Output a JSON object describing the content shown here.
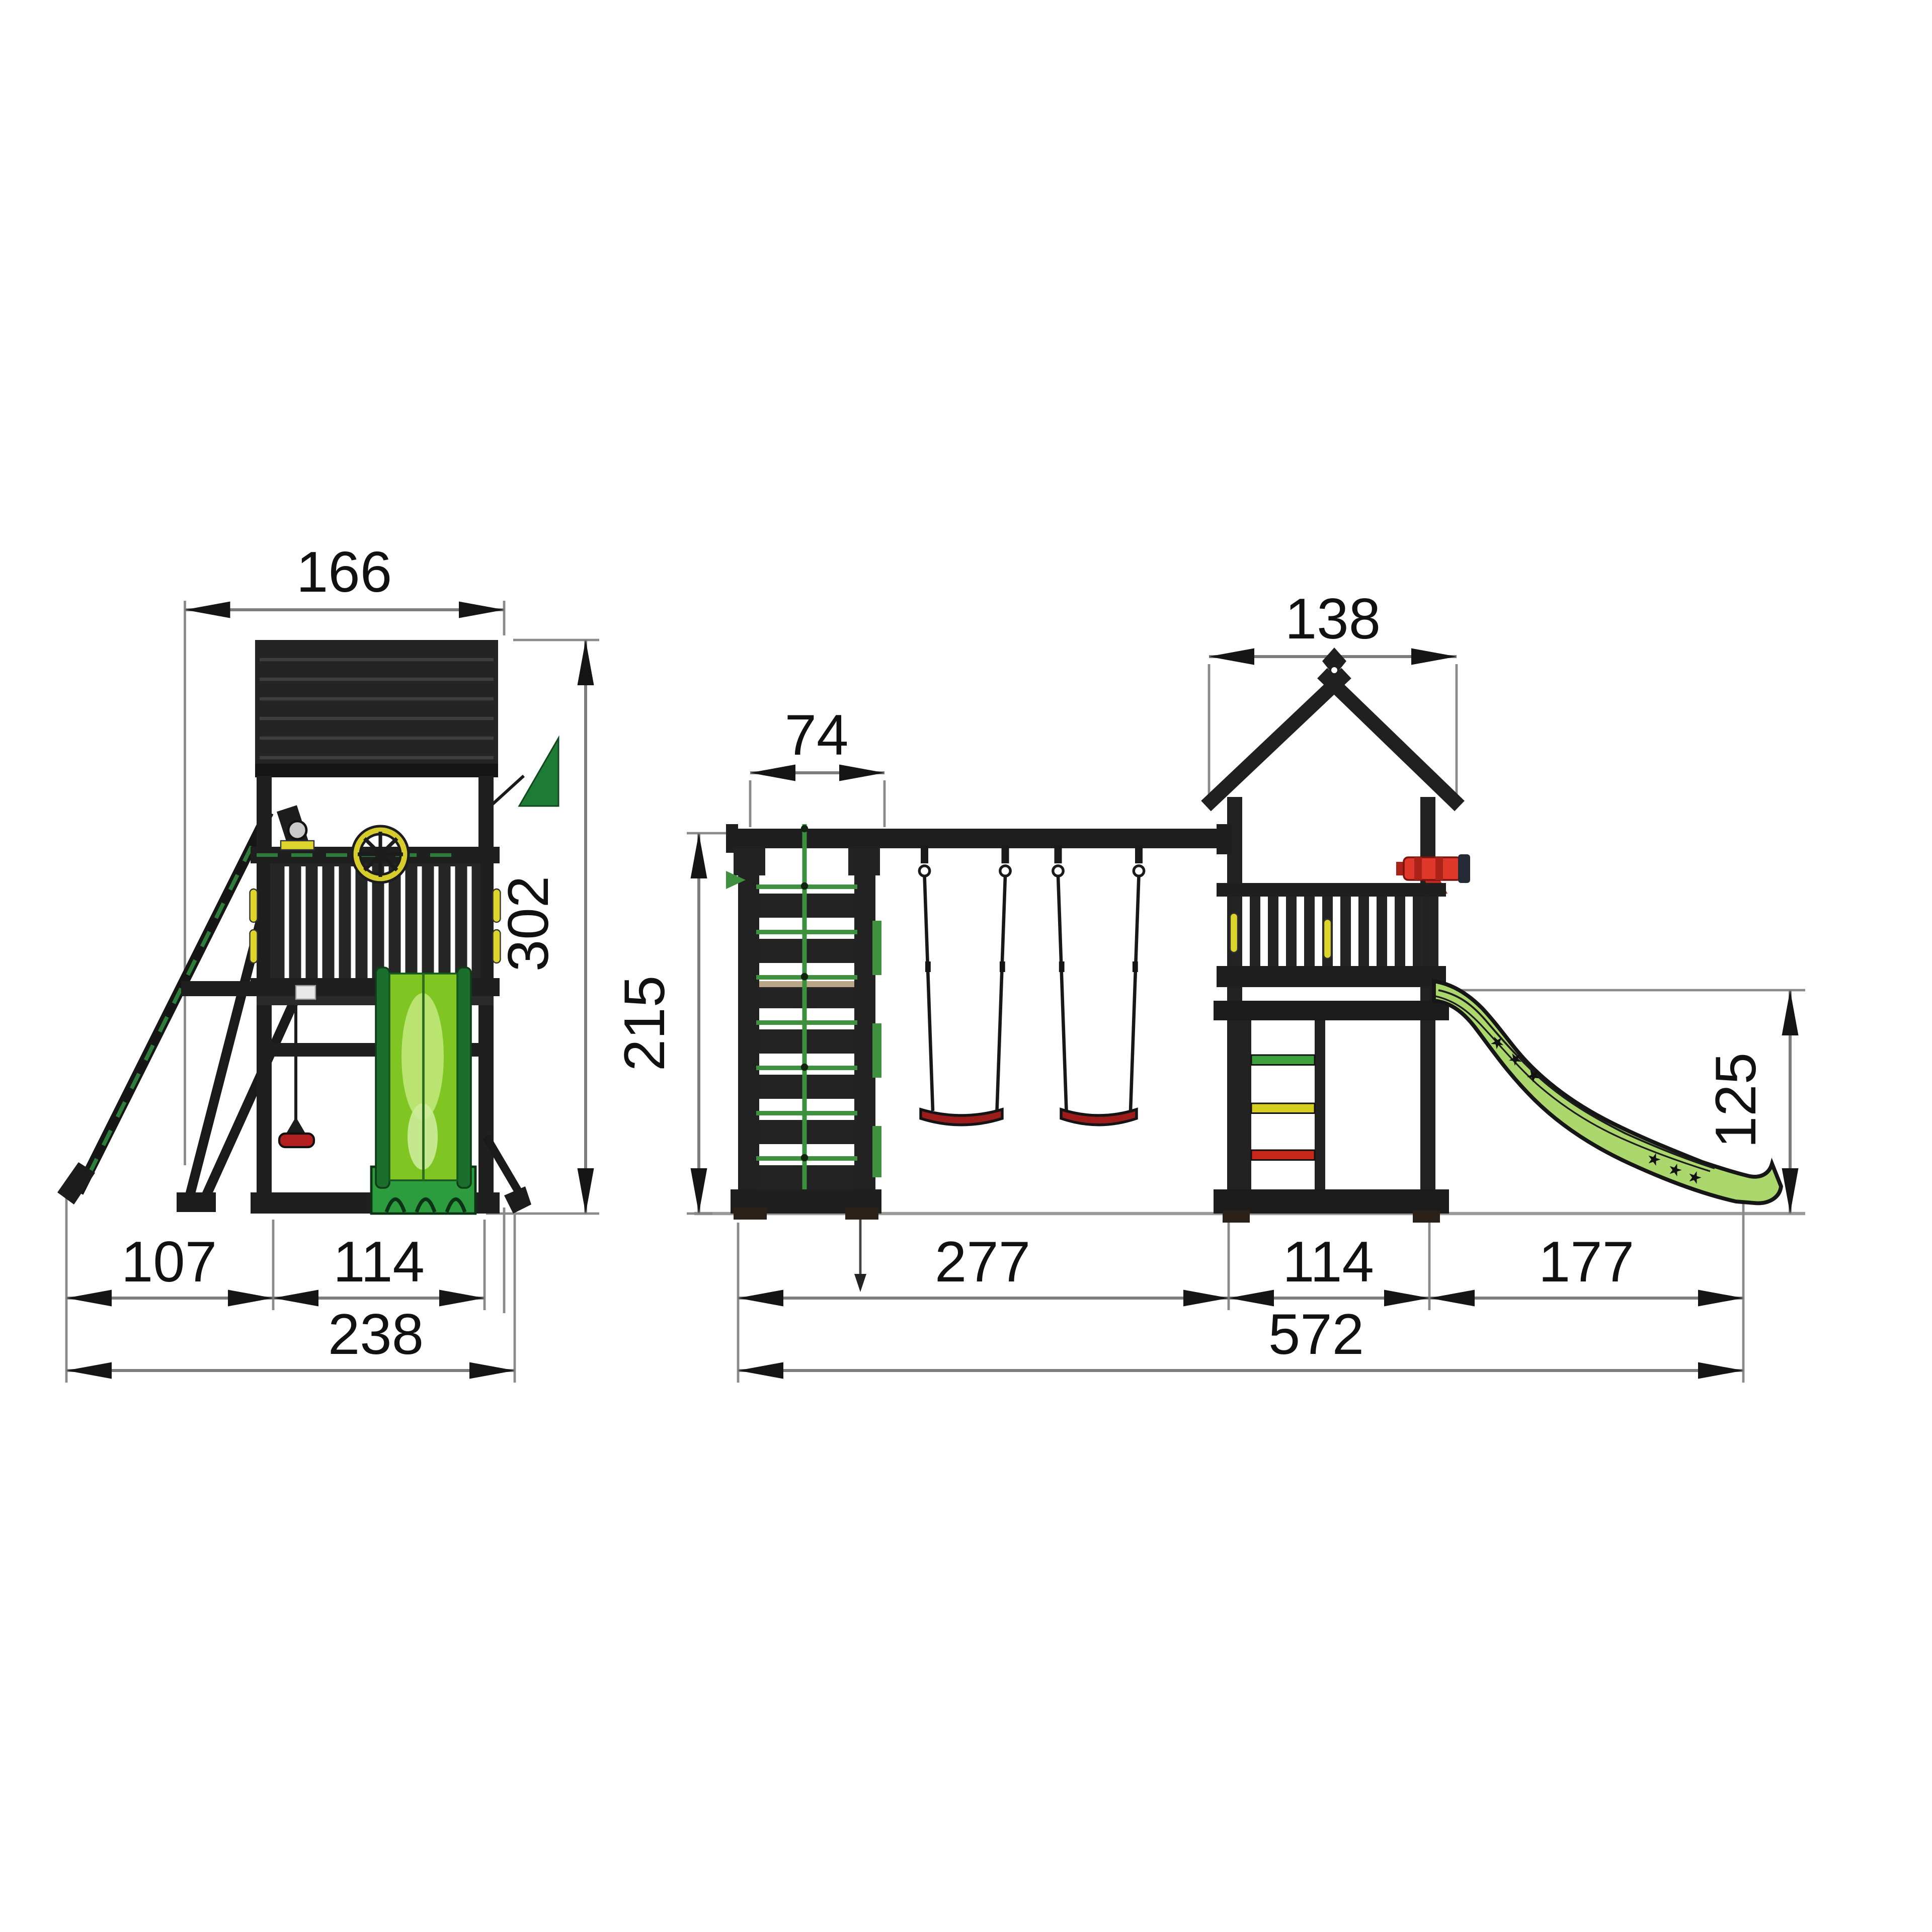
{
  "page": {
    "title": "Playground tower with swings, climbing frame and slide — dimension drawing",
    "background": "#ffffff",
    "units_note": ""
  },
  "side_view": {
    "name": "side-view",
    "dimensions": {
      "roof_depth": "166",
      "overall_height": "302",
      "brace_offset": "107",
      "tower_depth": "114",
      "overall_depth": "238"
    }
  },
  "front_view": {
    "name": "front-view",
    "dimensions": {
      "climbing_frame_width": "74",
      "beam_height": "215",
      "tower_roof_width": "138",
      "swing_bay_width": "277",
      "tower_width": "114",
      "slide_reach": "177",
      "overall_width": "572",
      "slide_height": "125"
    }
  },
  "colors": {
    "structure_dark": "#1f1f1f",
    "slide_green": "#7fc622",
    "slide_green_light": "#b9e46f",
    "slide_side_green": "#abd76d",
    "skirt_green": "#2d9c3f",
    "flag_green": "#1e7b35",
    "rope_green": "#3f9140",
    "rung_green": "#3ba23b",
    "rung_yellow": "#d6ce1f",
    "rung_red": "#c8281c",
    "seat_red": "#9c1c1c",
    "telescope_red": "#e0372b",
    "accent_yellow": "#ddd52c",
    "dim_line_gray": "#7d7d7d",
    "ground_gray": "#9a9a9a",
    "text_black": "#111111"
  }
}
